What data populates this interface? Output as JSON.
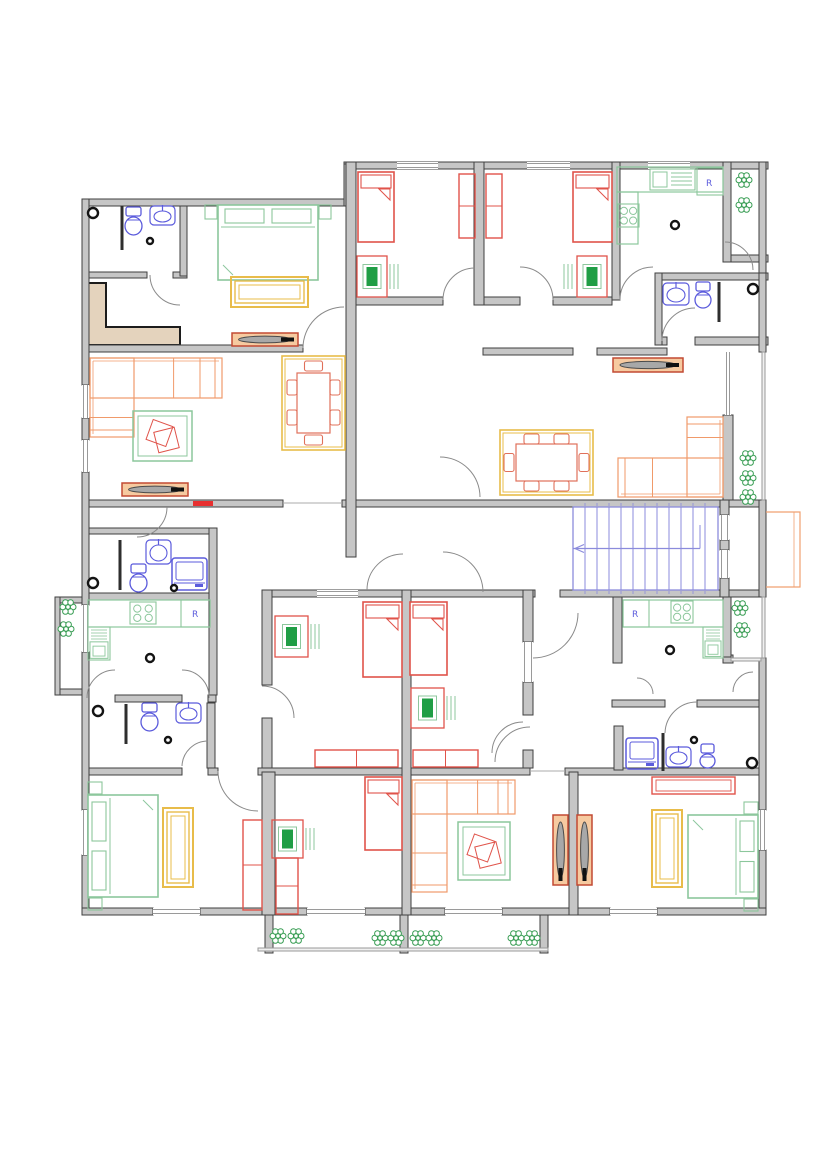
{
  "meta": {
    "title": "apartment-building-floor-plan",
    "canvas": {
      "w": 828,
      "h": 1171
    },
    "colors": {
      "wall_fill": "#c6c6c6",
      "wall_stroke": "#3f3f3f",
      "partition": "#2e2e2e",
      "door": "#8a8a8a",
      "window": "#9a9a9a",
      "red": "#e0534a",
      "red_bright": "#e83030",
      "green": "#8cc79c",
      "green_dark": "#1f9e45",
      "orange": "#f09a6a",
      "chair_orange": "#e0705a",
      "yellow": "#e8bc4a",
      "blue": "#5b5bdc",
      "stair_blue": "#8b8bdc",
      "plant": "#3a9e55",
      "tv_frame": "#c24a33",
      "tv_fill": "#f6caa0",
      "tan": "#e4d3bd",
      "railing": "#999999",
      "escape": "#f0a070"
    }
  },
  "walls": [
    [
      82,
      199,
      266,
      7
    ],
    [
      344,
      162,
      424,
      7
    ],
    [
      87,
      272,
      60,
      6
    ],
    [
      173,
      272,
      14,
      6
    ],
    [
      82,
      345,
      221,
      7
    ],
    [
      483,
      348,
      90,
      7
    ],
    [
      597,
      348,
      70,
      7
    ],
    [
      662,
      273,
      106,
      7
    ],
    [
      655,
      337,
      12,
      8
    ],
    [
      695,
      337,
      73,
      8
    ],
    [
      725,
      255,
      43,
      7
    ],
    [
      350,
      297,
      93,
      8
    ],
    [
      475,
      297,
      5,
      8
    ],
    [
      480,
      297,
      40,
      8
    ],
    [
      553,
      297,
      59,
      8
    ],
    [
      82,
      500,
      201,
      7
    ],
    [
      342,
      500,
      424,
      7
    ],
    [
      82,
      528,
      133,
      6
    ],
    [
      82,
      593,
      133,
      7
    ],
    [
      82,
      695,
      7,
      7
    ],
    [
      115,
      695,
      67,
      7
    ],
    [
      208,
      695,
      8,
      7
    ],
    [
      265,
      590,
      270,
      7
    ],
    [
      560,
      590,
      206,
      7
    ],
    [
      82,
      768,
      100,
      7
    ],
    [
      208,
      768,
      10,
      7
    ],
    [
      258,
      768,
      272,
      7
    ],
    [
      565,
      768,
      201,
      7
    ],
    [
      612,
      700,
      53,
      7
    ],
    [
      697,
      700,
      69,
      7
    ],
    [
      82,
      908,
      71,
      7
    ],
    [
      200,
      908,
      107,
      7
    ],
    [
      365,
      908,
      80,
      7
    ],
    [
      502,
      908,
      108,
      7
    ],
    [
      657,
      908,
      109,
      7
    ],
    [
      265,
      915,
      8,
      38
    ],
    [
      400,
      915,
      8,
      38
    ],
    [
      540,
      915,
      8,
      38
    ],
    [
      55,
      597,
      33,
      6
    ],
    [
      55,
      689,
      33,
      6
    ],
    [
      55,
      597,
      5,
      98
    ],
    [
      723,
      655,
      10,
      8
    ],
    [
      82,
      199,
      7,
      186
    ],
    [
      82,
      418,
      7,
      22
    ],
    [
      82,
      472,
      7,
      133
    ],
    [
      82,
      652,
      7,
      158
    ],
    [
      82,
      855,
      7,
      53
    ],
    [
      344,
      164,
      7,
      42
    ],
    [
      180,
      206,
      7,
      70
    ],
    [
      346,
      162,
      10,
      395
    ],
    [
      474,
      162,
      10,
      143
    ],
    [
      612,
      162,
      8,
      138
    ],
    [
      723,
      162,
      8,
      100
    ],
    [
      655,
      273,
      7,
      72
    ],
    [
      759,
      162,
      7,
      111
    ],
    [
      759,
      273,
      7,
      79
    ],
    [
      759,
      500,
      7,
      97
    ],
    [
      759,
      658,
      7,
      152
    ],
    [
      759,
      850,
      7,
      58
    ],
    [
      723,
      415,
      10,
      85
    ],
    [
      720,
      500,
      9,
      15
    ],
    [
      720,
      540,
      9,
      10
    ],
    [
      720,
      578,
      9,
      19
    ],
    [
      723,
      597,
      8,
      60
    ],
    [
      209,
      528,
      8,
      167
    ],
    [
      207,
      703,
      8,
      65
    ],
    [
      262,
      590,
      10,
      95
    ],
    [
      262,
      718,
      10,
      50
    ],
    [
      402,
      590,
      9,
      325
    ],
    [
      523,
      590,
      10,
      52
    ],
    [
      523,
      682,
      10,
      33
    ],
    [
      523,
      750,
      10,
      18
    ],
    [
      262,
      772,
      13,
      143
    ],
    [
      569,
      772,
      9,
      143
    ],
    [
      613,
      597,
      9,
      66
    ],
    [
      614,
      726,
      9,
      44
    ]
  ],
  "railings": [
    [
      762,
      352,
      3,
      148
    ],
    [
      762,
      597,
      3,
      61
    ],
    [
      258,
      948,
      290,
      3
    ],
    [
      731,
      658,
      30,
      3
    ]
  ],
  "windows": [
    [
      397,
      162,
      41,
      7
    ],
    [
      527,
      162,
      43,
      7
    ],
    [
      648,
      162,
      42,
      7
    ],
    [
      82,
      385,
      7,
      33
    ],
    [
      82,
      440,
      7,
      32
    ],
    [
      82,
      605,
      7,
      47
    ],
    [
      82,
      810,
      7,
      45
    ],
    [
      153,
      908,
      47,
      7
    ],
    [
      307,
      908,
      58,
      7
    ],
    [
      445,
      908,
      57,
      7
    ],
    [
      610,
      908,
      47,
      7
    ],
    [
      725,
      352,
      6,
      63
    ],
    [
      759,
      810,
      7,
      40
    ],
    [
      317,
      590,
      41,
      7
    ],
    [
      523,
      642,
      10,
      40
    ],
    [
      720,
      515,
      9,
      25
    ],
    [
      720,
      550,
      9,
      28
    ]
  ],
  "openings": [
    [
      283,
      503,
      342,
      503
    ],
    [
      530,
      771,
      565,
      771
    ]
  ],
  "partitions": [
    [
      122,
      206,
      122,
      250
    ],
    [
      120,
      540,
      120,
      590
    ],
    [
      126,
      704,
      126,
      744
    ],
    [
      663,
      733,
      663,
      771
    ],
    [
      719,
      282,
      719,
      322
    ]
  ],
  "threshold": {
    "x": 193,
    "y": 501,
    "w": 20,
    "h": 5
  },
  "entry_zone": {
    "points": "87,283 106,283 106,327 180,327 180,345 87,345"
  },
  "doors": [
    {
      "h": [
        180,
        275
      ],
      "e1": [
        150,
        275
      ],
      "e2": [
        180,
        305
      ]
    },
    {
      "h": [
        344,
        348
      ],
      "e1": [
        303,
        348
      ],
      "e2": [
        344,
        307
      ]
    },
    {
      "h": [
        475,
        300
      ],
      "e1": [
        443,
        300
      ],
      "e2": [
        475,
        268
      ]
    },
    {
      "h": [
        520,
        300
      ],
      "e1": [
        553,
        300
      ],
      "e2": [
        520,
        267
      ]
    },
    {
      "h": [
        653,
        300
      ],
      "e1": [
        620,
        300
      ],
      "e2": [
        653,
        267
      ]
    },
    {
      "h": [
        695,
        341
      ],
      "e1": [
        662,
        341
      ],
      "e2": [
        695,
        308
      ]
    },
    {
      "h": [
        725,
        270
      ],
      "e1": [
        753,
        270
      ],
      "e2": [
        725,
        242
      ]
    },
    {
      "h": [
        440,
        497
      ],
      "e1": [
        440,
        457
      ],
      "e2": [
        480,
        497
      ]
    },
    {
      "h": [
        137,
        507
      ],
      "e1": [
        167,
        507
      ],
      "e2": [
        137,
        537
      ]
    },
    {
      "h": [
        115,
        698
      ],
      "e1": [
        87,
        698
      ],
      "e2": [
        115,
        670
      ]
    },
    {
      "h": [
        182,
        698
      ],
      "e1": [
        209,
        698
      ],
      "e2": [
        182,
        670
      ]
    },
    {
      "h": [
        208,
        766
      ],
      "e1": [
        182,
        766
      ],
      "e2": [
        208,
        741
      ]
    },
    {
      "h": [
        258,
        771
      ],
      "e1": [
        218,
        771
      ],
      "e2": [
        258,
        811
      ]
    },
    {
      "h": [
        262,
        718
      ],
      "e1": [
        262,
        686
      ],
      "e2": [
        294,
        718
      ]
    },
    {
      "h": [
        523,
        753
      ],
      "e1": [
        523,
        722
      ],
      "e2": [
        492,
        753
      ]
    },
    {
      "h": [
        533,
        613
      ],
      "e1": [
        533,
        658
      ],
      "e2": [
        578,
        613
      ]
    },
    {
      "h": [
        530,
        762
      ],
      "e1": [
        495,
        762
      ],
      "e2": [
        530,
        727
      ]
    },
    {
      "h": [
        637,
        694
      ],
      "e1": [
        653,
        694
      ],
      "e2": [
        637,
        678
      ]
    },
    {
      "h": [
        753,
        692
      ],
      "e1": [
        733,
        692
      ],
      "e2": [
        753,
        672
      ]
    },
    {
      "h": [
        697,
        733
      ],
      "e1": [
        665,
        733
      ],
      "e2": [
        697,
        702
      ]
    },
    {
      "h": [
        443,
        592
      ],
      "e1": [
        443,
        552
      ],
      "e2": [
        483,
        592
      ]
    },
    {
      "h": [
        403,
        590
      ],
      "e1": [
        367,
        590
      ],
      "e2": [
        403,
        554
      ]
    }
  ],
  "stairs": {
    "x": 573,
    "y": 507,
    "w": 145,
    "h": 83,
    "steps": 11,
    "step_gap": 12,
    "mid_cut": 127
  },
  "escape": {
    "x": 766,
    "y": 512,
    "w": 34,
    "h": 75
  },
  "furniture": [
    {
      "t": "bed1",
      "x": 358,
      "y": 172,
      "w": 36,
      "h": 70
    },
    {
      "t": "bed1",
      "x": 573,
      "y": 172,
      "w": 39,
      "h": 70
    },
    {
      "t": "bed1",
      "x": 363,
      "y": 602,
      "w": 39,
      "h": 75
    },
    {
      "t": "bed1",
      "x": 410,
      "y": 602,
      "w": 37,
      "h": 73
    },
    {
      "t": "bed1",
      "x": 365,
      "y": 777,
      "w": 37,
      "h": 73
    },
    {
      "t": "bed2",
      "x": 218,
      "y": 205,
      "w": 100,
      "h": 75,
      "dir": "top"
    },
    {
      "t": "bed2",
      "x": 88,
      "y": 795,
      "w": 70,
      "h": 102,
      "dir": "left"
    },
    {
      "t": "bed2",
      "x": 688,
      "y": 815,
      "w": 70,
      "h": 83,
      "dir": "right"
    },
    {
      "t": "desk",
      "x": 357,
      "y": 256,
      "w": 30,
      "h": 41,
      "side": "right"
    },
    {
      "t": "desk",
      "x": 577,
      "y": 256,
      "w": 30,
      "h": 41,
      "side": "left"
    },
    {
      "t": "desk",
      "x": 275,
      "y": 616,
      "w": 33,
      "h": 41,
      "side": "right"
    },
    {
      "t": "desk",
      "x": 411,
      "y": 688,
      "w": 33,
      "h": 40,
      "side": "right"
    },
    {
      "t": "desk",
      "x": 272,
      "y": 820,
      "w": 31,
      "h": 38,
      "side": "right"
    },
    {
      "t": "ward_r",
      "x": 459,
      "y": 174,
      "w": 16,
      "h": 64
    },
    {
      "t": "ward_r",
      "x": 486,
      "y": 174,
      "w": 16,
      "h": 64
    },
    {
      "t": "ward_r",
      "x": 315,
      "y": 750,
      "w": 83,
      "h": 17
    },
    {
      "t": "ward_r",
      "x": 413,
      "y": 750,
      "w": 65,
      "h": 17
    },
    {
      "t": "ward_r",
      "x": 243,
      "y": 820,
      "w": 19,
      "h": 90
    },
    {
      "t": "ward_r",
      "x": 276,
      "y": 858,
      "w": 22,
      "h": 56
    },
    {
      "t": "dresser",
      "x": 652,
      "y": 777,
      "w": 83,
      "h": 17
    },
    {
      "t": "ward_y",
      "x": 231,
      "y": 277,
      "w": 77,
      "h": 30
    },
    {
      "t": "ward_y",
      "x": 163,
      "y": 808,
      "w": 30,
      "h": 79
    },
    {
      "t": "ward_y",
      "x": 652,
      "y": 810,
      "w": 30,
      "h": 77
    },
    {
      "t": "sofa",
      "x": 90,
      "y": 358,
      "w": 132,
      "h": 79,
      "arm": "tl",
      "tk": 40,
      "vk": 44
    },
    {
      "t": "sofa",
      "x": 618,
      "y": 417,
      "w": 105,
      "h": 80,
      "arm": "br",
      "tk": 39,
      "vk": 36
    },
    {
      "t": "sofa",
      "x": 412,
      "y": 780,
      "w": 103,
      "h": 112,
      "arm": "tl",
      "tk": 34,
      "vk": 35
    },
    {
      "t": "rug",
      "x": 133,
      "y": 411,
      "w": 59,
      "h": 50
    },
    {
      "t": "rug",
      "x": 458,
      "y": 822,
      "w": 52,
      "h": 58
    },
    {
      "t": "dining",
      "x": 282,
      "y": 356,
      "w": 63,
      "h": 94,
      "o": "v"
    },
    {
      "t": "dining",
      "x": 500,
      "y": 430,
      "w": 93,
      "h": 65,
      "o": "h"
    },
    {
      "t": "tv",
      "x": 232,
      "y": 333,
      "w": 66,
      "h": 13,
      "o": "h"
    },
    {
      "t": "tv",
      "x": 122,
      "y": 483,
      "w": 66,
      "h": 13,
      "o": "h"
    },
    {
      "t": "tv",
      "x": 613,
      "y": 358,
      "w": 70,
      "h": 14,
      "o": "h"
    },
    {
      "t": "tv",
      "x": 553,
      "y": 815,
      "w": 15,
      "h": 70,
      "o": "v"
    },
    {
      "t": "tv",
      "x": 577,
      "y": 815,
      "w": 15,
      "h": 70,
      "o": "v"
    },
    {
      "t": "counter",
      "x": 88,
      "y": 600,
      "w": 122,
      "h": 27
    },
    {
      "t": "stove",
      "x": 130,
      "y": 602,
      "w": 26,
      "h": 22
    },
    {
      "t": "fridge",
      "x": 181,
      "y": 600,
      "w": 29,
      "h": 27
    },
    {
      "t": "ovenCol",
      "x": 88,
      "y": 627,
      "w": 22,
      "h": 33
    },
    {
      "t": "counter",
      "x": 617,
      "y": 167,
      "w": 106,
      "h": 25
    },
    {
      "t": "sinkK",
      "x": 650,
      "y": 169,
      "w": 45,
      "h": 21
    },
    {
      "t": "counter",
      "x": 617,
      "y": 192,
      "w": 21,
      "h": 52
    },
    {
      "t": "stove",
      "x": 618,
      "y": 204,
      "w": 21,
      "h": 23
    },
    {
      "t": "fridge",
      "x": 697,
      "y": 168,
      "w": 26,
      "h": 27
    },
    {
      "t": "counter",
      "x": 623,
      "y": 600,
      "w": 100,
      "h": 27
    },
    {
      "t": "fridge",
      "x": 623,
      "y": 600,
      "w": 26,
      "h": 27
    },
    {
      "t": "stove",
      "x": 671,
      "y": 601,
      "w": 22,
      "h": 22
    },
    {
      "t": "ovenCol",
      "x": 703,
      "y": 627,
      "w": 20,
      "h": 31
    },
    {
      "t": "toilet",
      "x": 124,
      "y": 207,
      "w": 19,
      "h": 30
    },
    {
      "t": "sinkB",
      "x": 150,
      "y": 206,
      "w": 25,
      "h": 19
    },
    {
      "t": "sinkB",
      "x": 146,
      "y": 540,
      "w": 25,
      "h": 24
    },
    {
      "t": "toilet",
      "x": 129,
      "y": 564,
      "w": 19,
      "h": 30
    },
    {
      "t": "washer",
      "x": 172,
      "y": 558,
      "w": 35,
      "h": 32
    },
    {
      "t": "toilet",
      "x": 140,
      "y": 703,
      "w": 19,
      "h": 30
    },
    {
      "t": "sinkB",
      "x": 176,
      "y": 703,
      "w": 25,
      "h": 20
    },
    {
      "t": "sinkB",
      "x": 663,
      "y": 283,
      "w": 26,
      "h": 22
    },
    {
      "t": "toilet",
      "x": 694,
      "y": 282,
      "w": 18,
      "h": 28
    },
    {
      "t": "washer",
      "x": 626,
      "y": 738,
      "w": 32,
      "h": 31
    },
    {
      "t": "sinkB",
      "x": 666,
      "y": 747,
      "w": 25,
      "h": 20
    },
    {
      "t": "toilet",
      "x": 699,
      "y": 744,
      "w": 17,
      "h": 26
    }
  ],
  "plants": [
    [
      68,
      607
    ],
    [
      66,
      629
    ],
    [
      744,
      180
    ],
    [
      744,
      205
    ],
    [
      748,
      458
    ],
    [
      748,
      478
    ],
    [
      748,
      497
    ],
    [
      740,
      608
    ],
    [
      742,
      630
    ],
    [
      278,
      936
    ],
    [
      296,
      936
    ],
    [
      380,
      938
    ],
    [
      396,
      938
    ],
    [
      418,
      938
    ],
    [
      434,
      938
    ],
    [
      516,
      938
    ],
    [
      532,
      938
    ]
  ],
  "knobs": [
    [
      93,
      213,
      5
    ],
    [
      150,
      241,
      3
    ],
    [
      675,
      225,
      4
    ],
    [
      753,
      289,
      5
    ],
    [
      93,
      583,
      5
    ],
    [
      174,
      588,
      3
    ],
    [
      150,
      658,
      4
    ],
    [
      98,
      711,
      5
    ],
    [
      168,
      740,
      3
    ],
    [
      670,
      650,
      4
    ],
    [
      694,
      740,
      3
    ],
    [
      752,
      763,
      5
    ]
  ],
  "labels": [
    {
      "t": "R",
      "x": 192,
      "y": 617
    },
    {
      "t": "R",
      "x": 706,
      "y": 186
    },
    {
      "t": "R",
      "x": 632,
      "y": 617
    }
  ]
}
